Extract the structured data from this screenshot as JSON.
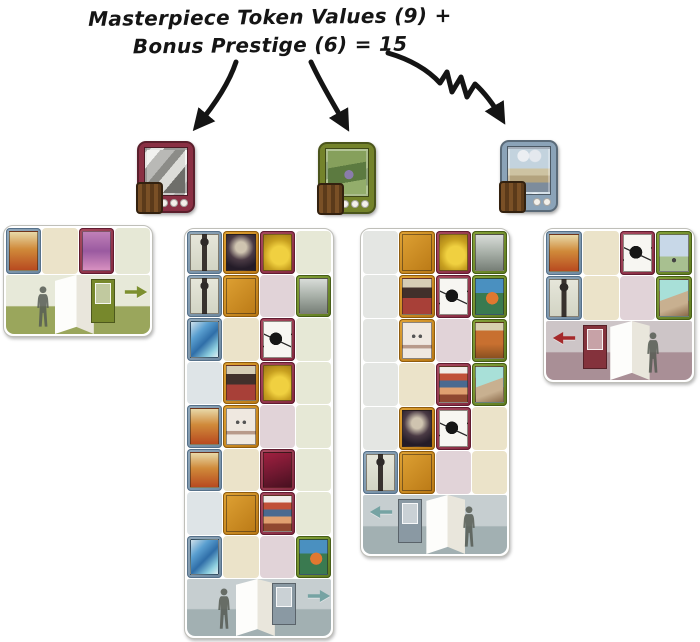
{
  "title": {
    "line1": "Masterpiece Token Values (9) +",
    "line2": "Bonus Prestige (6) = 15"
  },
  "summary": {
    "masterpiece_total": 9,
    "bonus_prestige": 6,
    "total": 15
  },
  "colors": {
    "annotation_ink": "#141414",
    "frame_blue": "#7e96aa",
    "frame_orange": "#c8861c",
    "frame_maroon": "#96374a",
    "frame_green": "#6e8c2a",
    "slot_cream": "#ebe3c9",
    "slot_mauve": "#e1d3d8",
    "slot_green": "#e6e8d6",
    "slot_blue": "#dee4e7",
    "slot_gray": "#e4e6e3"
  },
  "tokens": [
    {
      "name": "masterpiece-token-maroon",
      "frame_color": "#8a3044",
      "value": 4,
      "art": "grayscale-cubist"
    },
    {
      "name": "masterpiece-token-green",
      "frame_color": "#74832b",
      "value": 3,
      "art": "green-forest"
    },
    {
      "name": "masterpiece-token-blue",
      "frame_color": "#8ba3b8",
      "value": 2,
      "art": "surreal-sky"
    }
  ],
  "boards": [
    {
      "name": "gallery-board-left",
      "x": 3,
      "y": 225,
      "w": 150,
      "row_h": 46,
      "scene_h": 59,
      "rows": [
        [
          {
            "frame": "blue",
            "art": "still-life"
          },
          {
            "empty": "cream"
          },
          {
            "frame": "maroon",
            "art": "purple-abstract"
          },
          {
            "empty": "green"
          }
        ]
      ],
      "scene": {
        "wall": "#e7e9d9",
        "floor": "#9aa65c",
        "panel_x": 34,
        "door_x": 59,
        "door_color": "#77882c",
        "person_x": 18,
        "arrow_dir": "right",
        "arrow_color": "#7d9030",
        "arrow_x": 82
      }
    },
    {
      "name": "gallery-board-mid-left",
      "x": 184,
      "y": 228,
      "w": 150,
      "row_h": 42.5,
      "scene_h": 57,
      "rows": [
        [
          {
            "frame": "blue",
            "art": "figure"
          },
          {
            "frame": "orange",
            "art": "portrait-dark"
          },
          {
            "frame": "maroon",
            "art": "abstract-yellow"
          },
          {
            "empty": "green"
          }
        ],
        [
          {
            "frame": "blue",
            "art": "figure"
          },
          {
            "frame": "orange",
            "art": "fish-teal"
          },
          {
            "empty": "mauve"
          },
          {
            "frame": "green",
            "art": "landscape-gray"
          }
        ],
        [
          {
            "frame": "blue",
            "art": "abstract-blue"
          },
          {
            "empty": "cream"
          },
          {
            "frame": "maroon",
            "art": "masterpiece"
          },
          {
            "empty": "green"
          }
        ],
        [
          {
            "empty": "blue"
          },
          {
            "frame": "orange",
            "art": "portrait-red"
          },
          {
            "frame": "maroon",
            "art": "abstract-yellow"
          },
          {
            "empty": "green"
          }
        ],
        [
          {
            "frame": "blue",
            "art": "still-life"
          },
          {
            "frame": "orange",
            "art": "face-white"
          },
          {
            "empty": "mauve"
          },
          {
            "empty": "green"
          }
        ],
        [
          {
            "frame": "blue",
            "art": "still-life"
          },
          {
            "empty": "cream"
          },
          {
            "frame": "maroon",
            "art": "abstract-red"
          },
          {
            "empty": "green"
          }
        ],
        [
          {
            "empty": "blue"
          },
          {
            "frame": "orange",
            "art": "fish-teal"
          },
          {
            "frame": "maroon",
            "art": "sunset-stripes"
          },
          {
            "empty": "green"
          }
        ],
        [
          {
            "frame": "blue",
            "art": "abstract-blue"
          },
          {
            "empty": "cream"
          },
          {
            "empty": "mauve"
          },
          {
            "frame": "green",
            "art": "landscape-colorful"
          }
        ]
      ],
      "scene": {
        "wall": "#c6ced0",
        "floor": "#a2b0b2",
        "panel_x": 34,
        "door_x": 59,
        "door_color": "#8a99a3",
        "person_x": 18,
        "arrow_dir": "right",
        "arrow_color": "#76a3a3",
        "arrow_x": 83
      }
    },
    {
      "name": "gallery-board-mid-right",
      "x": 360,
      "y": 228,
      "w": 150,
      "row_h": 43,
      "scene_h": 59,
      "rows": [
        [
          {
            "empty": "gray"
          },
          {
            "frame": "orange",
            "art": "fish-teal"
          },
          {
            "frame": "maroon",
            "art": "abstract-yellow"
          },
          {
            "frame": "green",
            "art": "landscape-gray"
          }
        ],
        [
          {
            "empty": "gray"
          },
          {
            "frame": "orange",
            "art": "portrait-red"
          },
          {
            "frame": "maroon",
            "art": "masterpiece"
          },
          {
            "frame": "green",
            "art": "landscape-colorful"
          }
        ],
        [
          {
            "empty": "gray"
          },
          {
            "frame": "orange",
            "art": "face-white"
          },
          {
            "empty": "mauve"
          },
          {
            "frame": "green",
            "art": "landscape-autumn"
          }
        ],
        [
          {
            "empty": "gray"
          },
          {
            "empty": "cream"
          },
          {
            "frame": "maroon",
            "art": "sunset-stripes"
          },
          {
            "frame": "green",
            "art": "landscape-beach"
          }
        ],
        [
          {
            "empty": "gray"
          },
          {
            "frame": "orange",
            "art": "portrait-dark"
          },
          {
            "frame": "maroon",
            "art": "masterpiece"
          },
          {
            "empty": "cream"
          }
        ],
        [
          {
            "frame": "blue",
            "art": "figure"
          },
          {
            "frame": "orange",
            "art": "fish-teal"
          },
          {
            "empty": "mauve"
          },
          {
            "empty": "cream"
          }
        ]
      ],
      "scene": {
        "wall": "#c6ced0",
        "floor": "#a2b0b2",
        "panel_x": 44,
        "door_x": 24,
        "door_color": "#8a99a3",
        "person_x": 66,
        "arrow_dir": "left",
        "arrow_color": "#76a3a3",
        "arrow_x": 4
      }
    },
    {
      "name": "gallery-board-right",
      "x": 543,
      "y": 228,
      "w": 152,
      "row_h": 44,
      "scene_h": 59,
      "rows": [
        [
          {
            "frame": "blue",
            "art": "still-life"
          },
          {
            "empty": "cream"
          },
          {
            "frame": "maroon",
            "art": "masterpiece"
          },
          {
            "frame": "green",
            "art": "landscape-sky"
          }
        ],
        [
          {
            "frame": "blue",
            "art": "figure"
          },
          {
            "empty": "cream"
          },
          {
            "empty": "mauve"
          },
          {
            "frame": "green",
            "art": "landscape-beach"
          }
        ]
      ],
      "scene": {
        "wall": "#cdc5c7",
        "floor": "#a98f96",
        "panel_x": 44,
        "door_x": 25,
        "door_color": "#84323c",
        "person_x": 66,
        "arrow_dir": "left",
        "arrow_color": "#a5292b",
        "arrow_x": 4
      }
    }
  ]
}
